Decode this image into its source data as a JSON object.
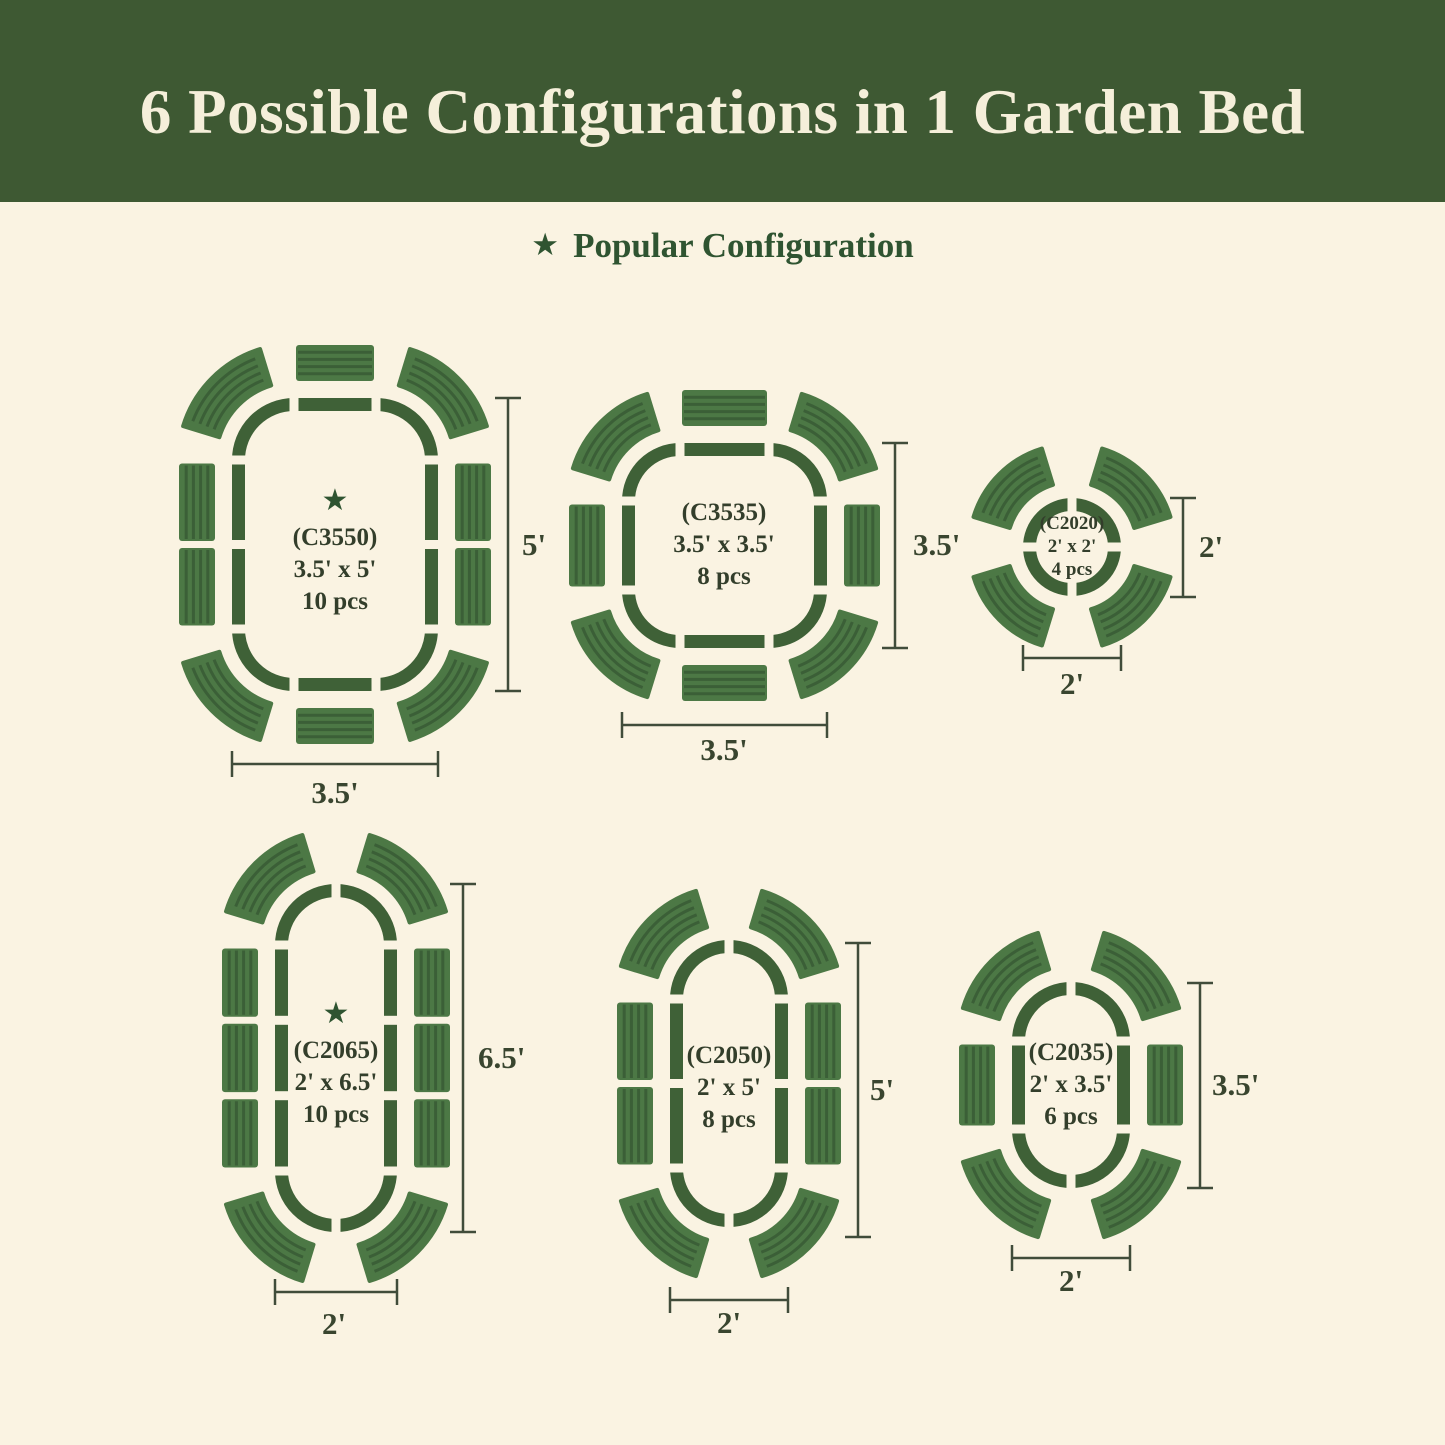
{
  "title": "6 Possible Configurations in 1 Garden Bed",
  "legend": {
    "star_glyph": "★",
    "label": "Popular Configuration"
  },
  "colors": {
    "banner_background": "#3E5933",
    "banner_text": "#F5EFDA",
    "page_background": "#FAF3E2",
    "bed_outline_green": "#3F6137",
    "panel_green": "#4C7845",
    "panel_stripe_green": "#3B5F37",
    "label_text": "#333E2B",
    "dimension_line": "#404C3A",
    "legend_green": "#2F5431"
  },
  "configs": [
    {
      "code": "(C3550)",
      "size": "3.5' x 5'",
      "pieces": "10 pcs",
      "popular": true,
      "height_label": "5'",
      "width_label": "3.5'"
    },
    {
      "code": "(C3535)",
      "size": "3.5' x 3.5'",
      "pieces": "8 pcs",
      "popular": false,
      "height_label": "3.5'",
      "width_label": "3.5'"
    },
    {
      "code": "(C2020)",
      "size": "2' x 2'",
      "pieces": "4 pcs",
      "popular": false,
      "height_label": "2'",
      "width_label": "2'"
    },
    {
      "code": "(C2065)",
      "size": "2' x 6.5'",
      "pieces": "10 pcs",
      "popular": true,
      "height_label": "6.5'",
      "width_label": "2'"
    },
    {
      "code": "(C2050)",
      "size": "2' x 5'",
      "pieces": "8 pcs",
      "popular": false,
      "height_label": "5'",
      "width_label": "2'"
    },
    {
      "code": "(C2035)",
      "size": "2' x 3.5'",
      "pieces": "6 pcs",
      "popular": false,
      "height_label": "3.5'",
      "width_label": "2'"
    }
  ]
}
